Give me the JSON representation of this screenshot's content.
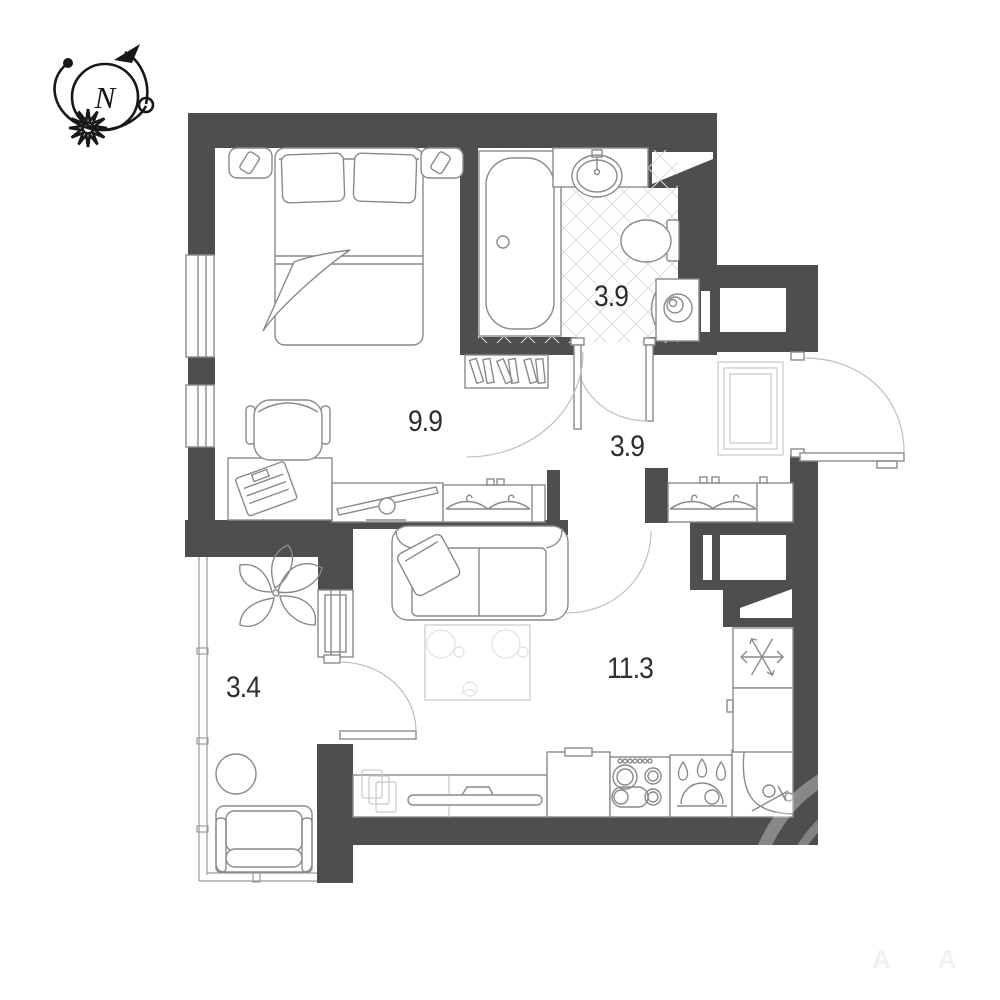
{
  "title": "apartment-floor-plan",
  "compass": {
    "label": "N"
  },
  "rooms": [
    {
      "id": "bedroom",
      "area": "9.9"
    },
    {
      "id": "bathroom",
      "area": "3.9"
    },
    {
      "id": "hallway",
      "area": "3.9"
    },
    {
      "id": "living-kitchen",
      "area": "11.3"
    },
    {
      "id": "balcony",
      "area": "3.4"
    }
  ],
  "watermark": {
    "letters": [
      "A",
      "A"
    ]
  },
  "colors": {
    "wall": "#4e4e4e",
    "furniture_line": "#8a8a8a",
    "light_line": "#c9c9c9",
    "tile_line": "#dedede",
    "label_text": "#2e2e2e"
  }
}
